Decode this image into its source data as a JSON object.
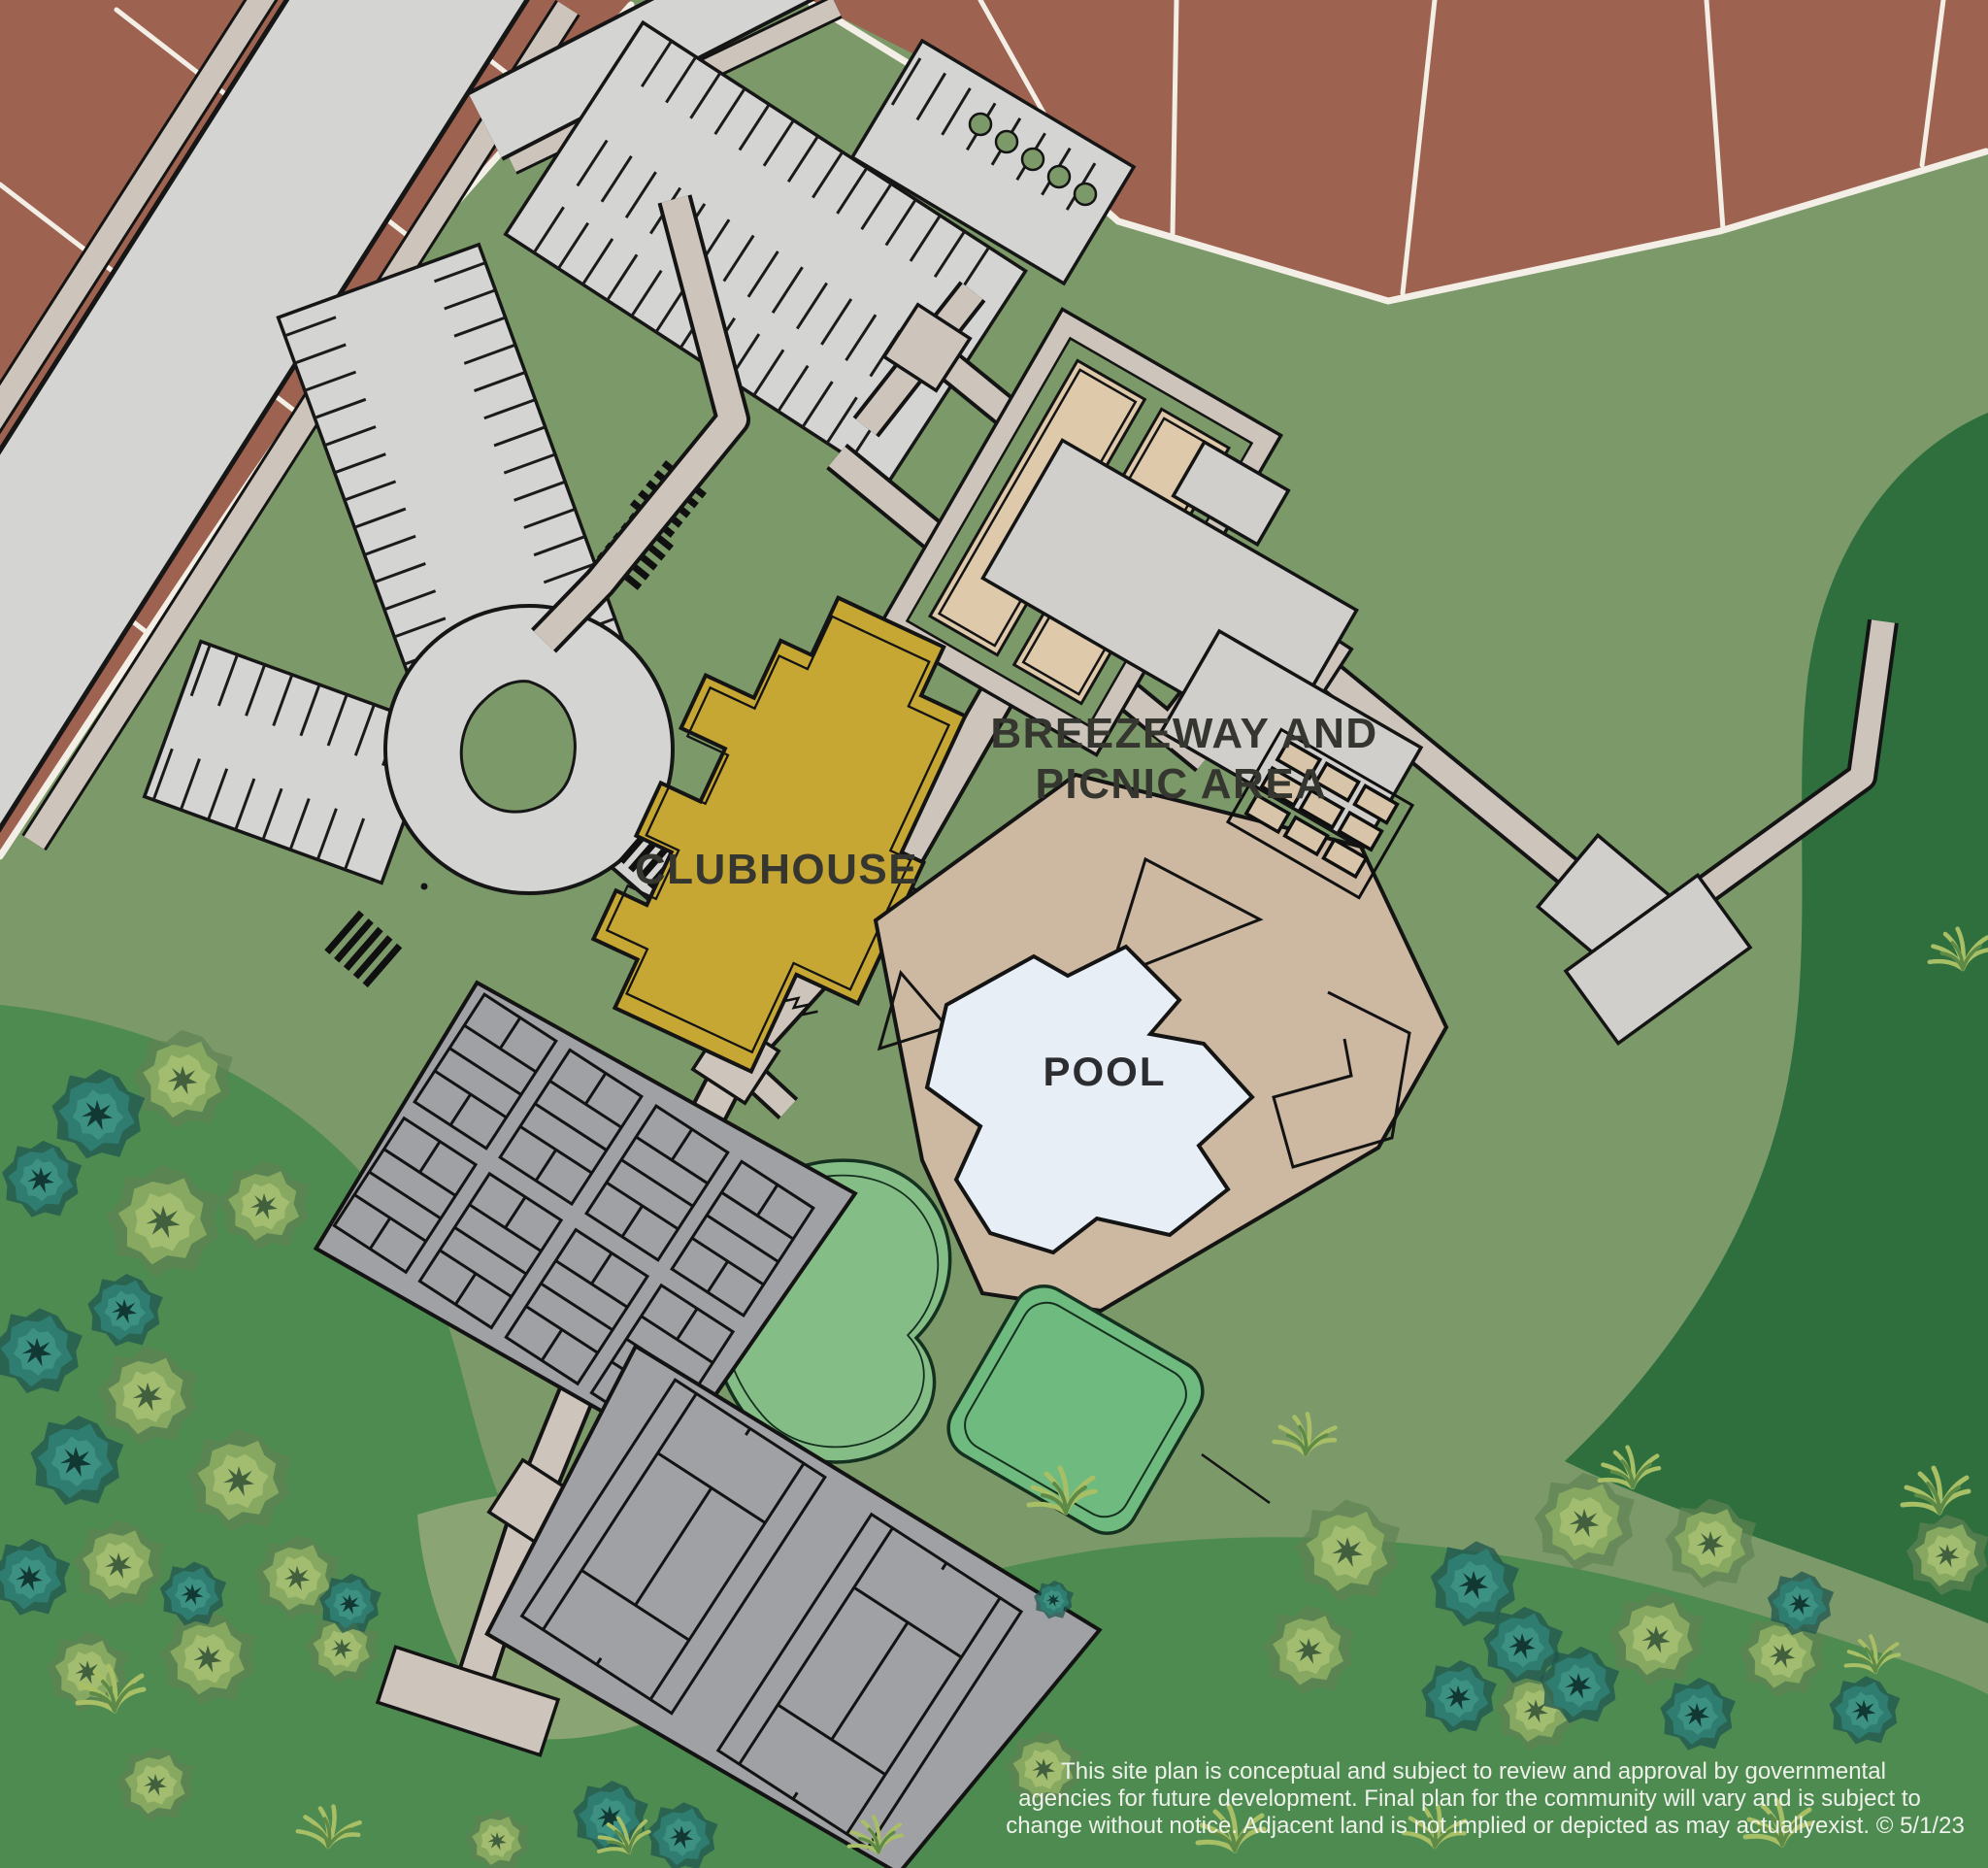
{
  "labels": {
    "clubhouse": "CLUBHOUSE",
    "breezeway_line1": "BREEZEWAY AND",
    "breezeway_line2": "PICNIC AREA",
    "pool": "POOL"
  },
  "disclaimer": {
    "line1": "This site plan is conceptual and subject to review and approval by governmental",
    "line2": "agencies for future development. Final plan for the community will vary and is subject to",
    "line3": "change without notice. Adjacent land is not implied or depicted as may actuallyexist. © 5/1/23"
  },
  "palette": {
    "grass_base": "#7c9969",
    "grass_shadow": "#41804b",
    "grass_bright": "#4e8b51",
    "grass_pale": "#8ba473",
    "grass_dark": "#2f6f3e",
    "lot_brown": "#9e6350",
    "lot_line": "#f3efe6",
    "road_gray": "#d4d4d2",
    "sidewalk_tan": "#cdc5bb",
    "plaza_gray": "#d1cfcc",
    "clubhouse_gold": "#c7a733",
    "pool_deck_tan": "#cdb9a1",
    "pool_blue": "#e7eef6",
    "court_gray": "#9fa1a5",
    "lawn_green": "#85bd86",
    "lawn_green_bright": "#6fba7e",
    "bocce_tan": "#dfc9ab",
    "tree_light": "#86a861",
    "tree_teal": "#2f7d71",
    "outline_black": "#161616",
    "label_dark": "#35362f",
    "disclaimer_white": "#eef2ea"
  }
}
